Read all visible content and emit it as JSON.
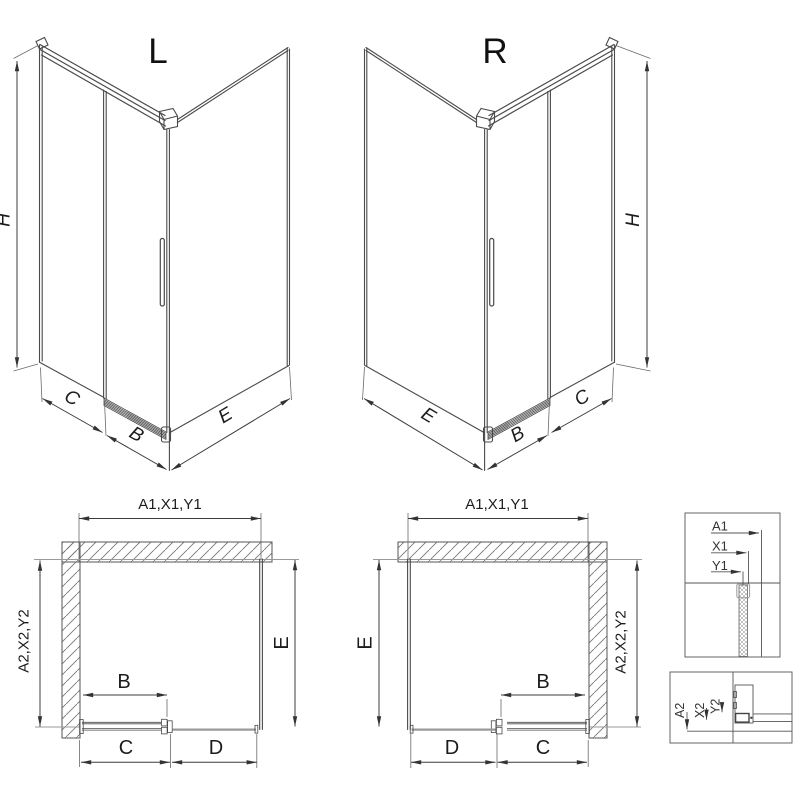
{
  "views": {
    "iso_left": {
      "title": "L",
      "height": "H",
      "fixed": "C",
      "door": "B",
      "side": "E"
    },
    "iso_right": {
      "title": "R",
      "height": "H",
      "fixed": "C",
      "door": "B",
      "side": "E"
    },
    "plan_left": {
      "width_group": "A1,X1,Y1",
      "depth_group": "A2,X2,Y2",
      "side": "E",
      "door": "B",
      "fixed": "C",
      "open": "D"
    },
    "plan_right": {
      "width_group": "A1,X1,Y1",
      "depth_group": "A2,X2,Y2",
      "side": "E",
      "door": "B",
      "open": "D",
      "fixed": "C"
    },
    "detail_top": {
      "a": "A1",
      "x": "X1",
      "y": "Y1"
    },
    "detail_bottom": {
      "a": "A2",
      "x": "X2",
      "y": "Y2"
    }
  },
  "colors": {
    "line": "#4a4a4a",
    "dimension": "#3c3c3c",
    "hatch": "#777777",
    "light": "#9a9a9a"
  }
}
